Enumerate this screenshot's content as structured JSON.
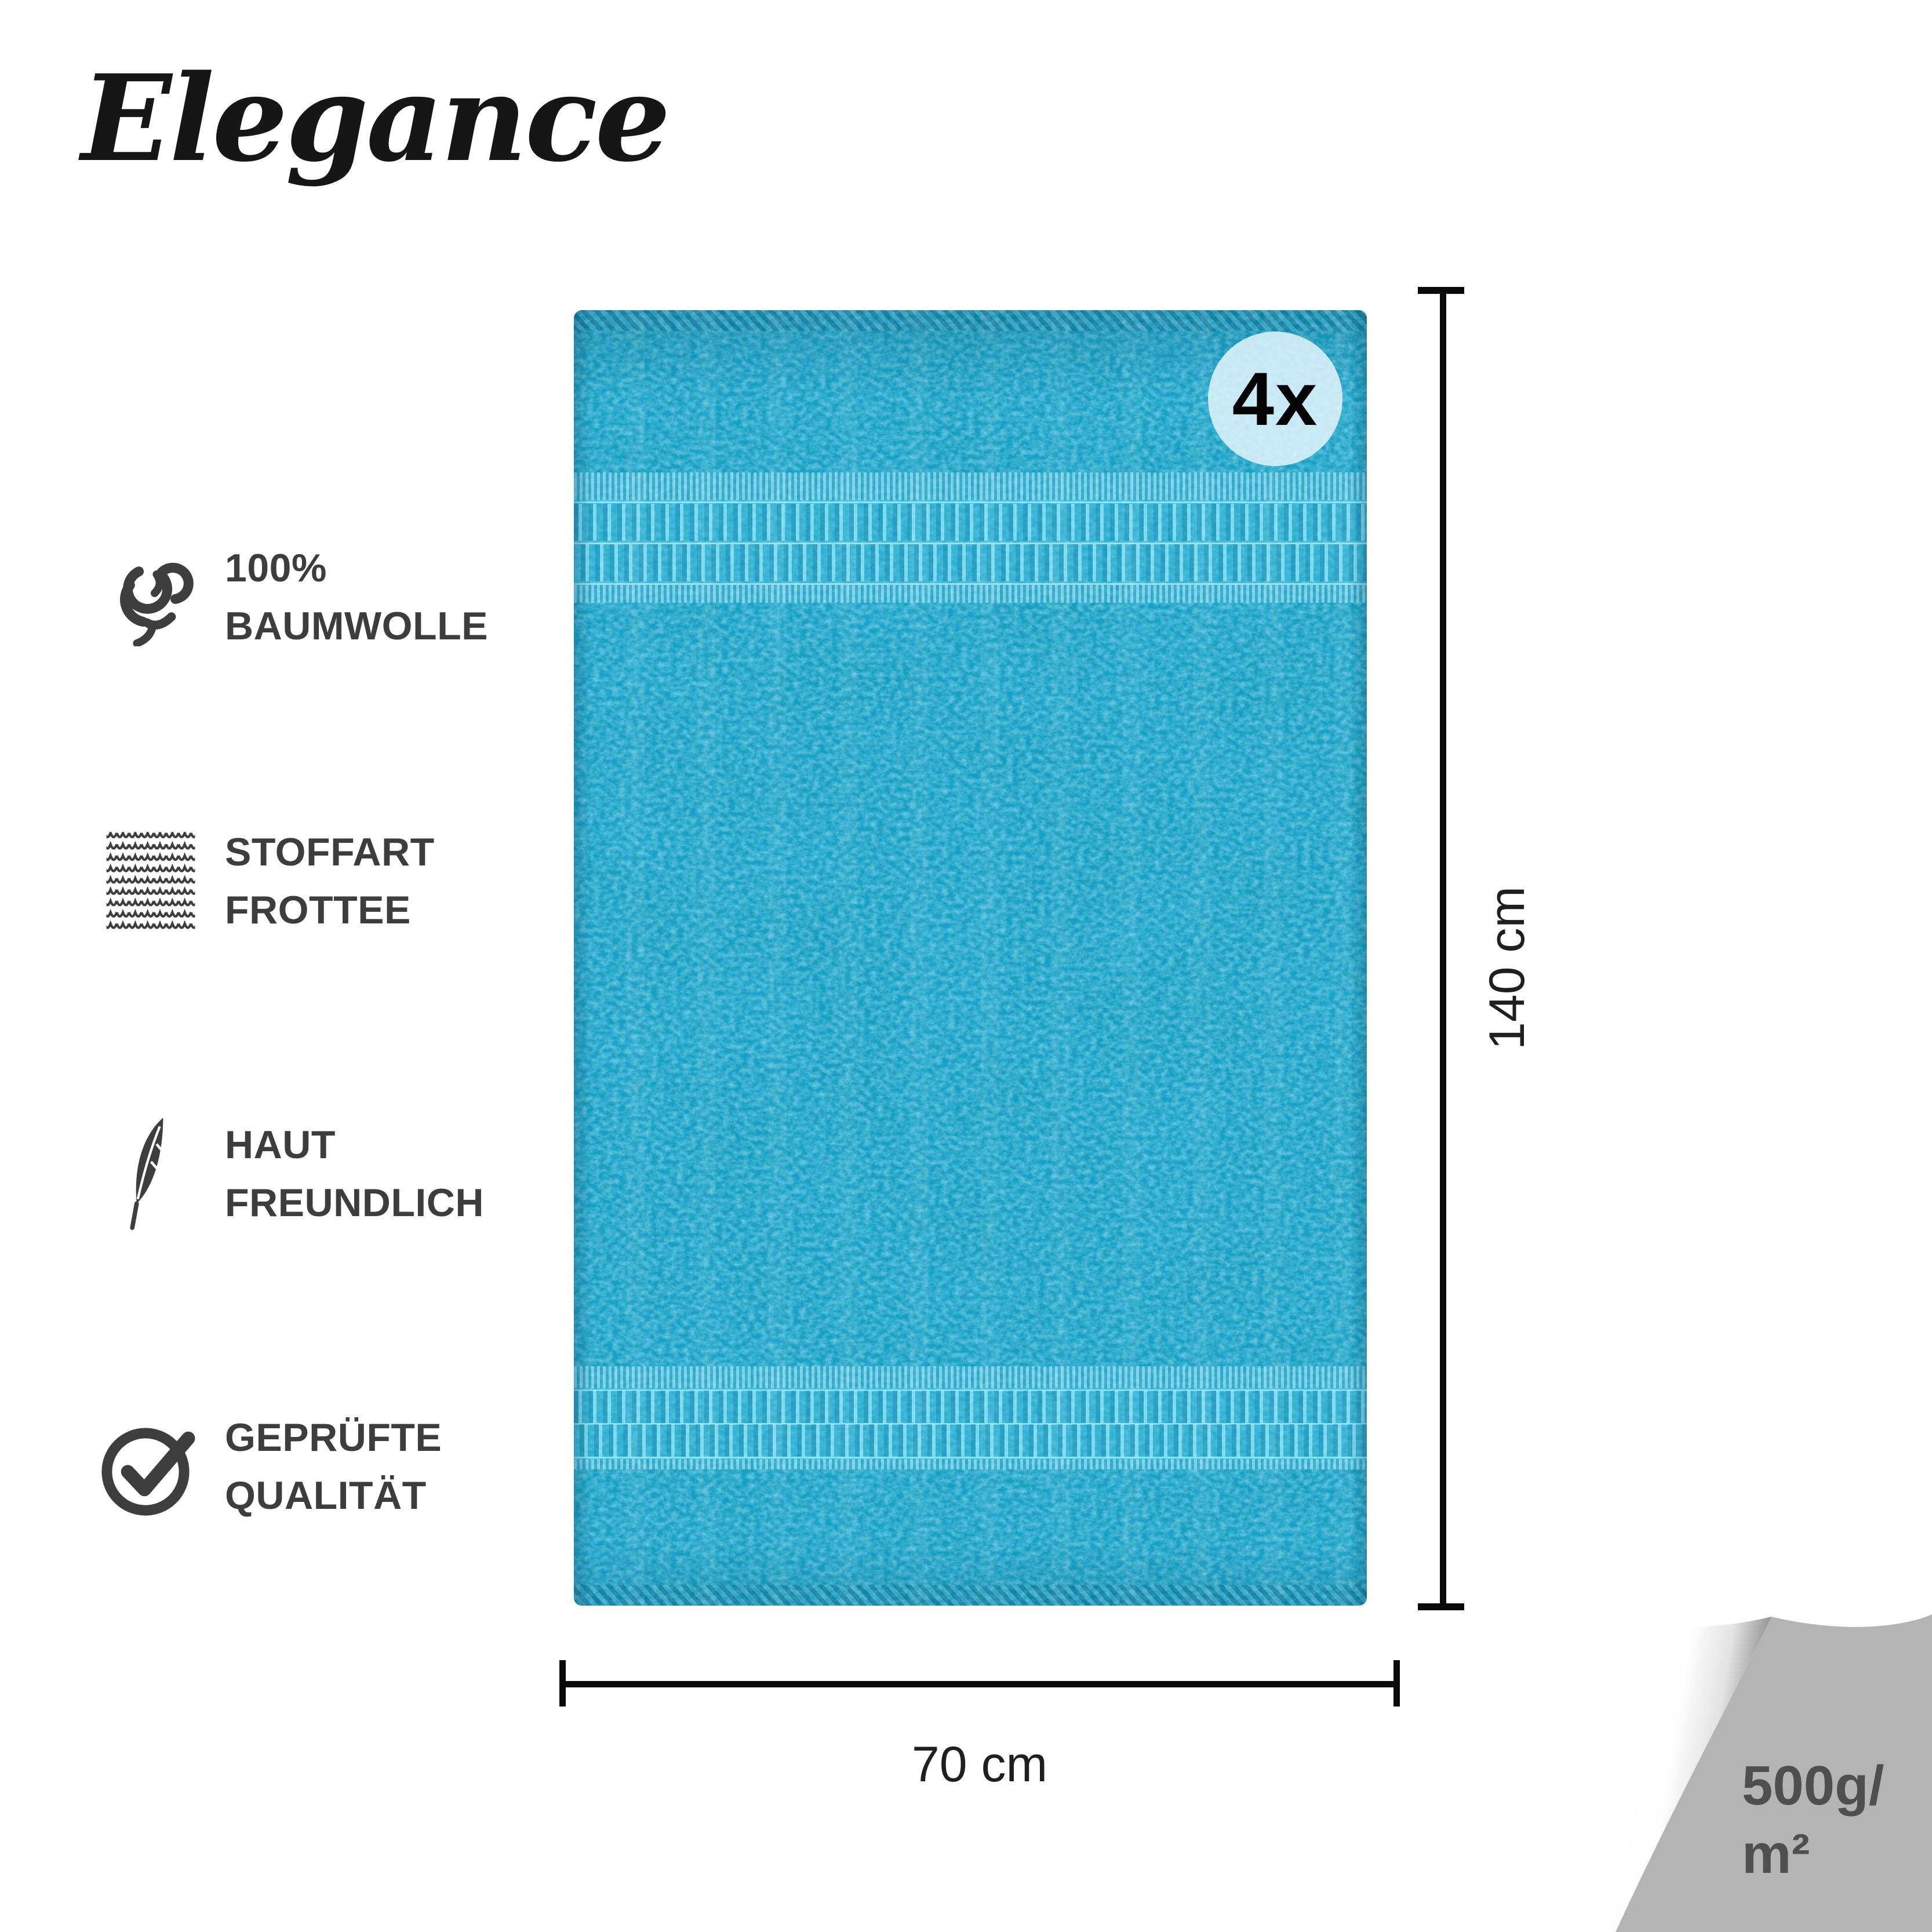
{
  "brand": {
    "logo_text": "Elegance"
  },
  "features": [
    {
      "icon": "cotton-icon",
      "line1": "100%",
      "line2": "BAUMWOLLE"
    },
    {
      "icon": "knit-fabric-icon",
      "line1": "STOFFART",
      "line2": "FROTTEE"
    },
    {
      "icon": "feather-icon",
      "line1": "HAUT",
      "line2": "FREUNDLICH"
    },
    {
      "icon": "check-circle-icon",
      "line1": "GEPRÜFTE",
      "line2": "QUALITÄT"
    }
  ],
  "product": {
    "quantity_badge": "4x",
    "dimensions": {
      "height": "140 cm",
      "width": "70 cm"
    },
    "weight": {
      "line1": "500g/",
      "line2": "m²"
    },
    "colors": {
      "towel_base": "#16a4ce",
      "towel_dark": "#0b82ad",
      "towel_light": "#35c2e8",
      "badge_bg": "#def3fa",
      "feature_text": "#3d3d3d",
      "dimension_text": "#1f1f1f",
      "corner_gray": "#b4b4b4",
      "weight_text": "#4f4f4f"
    }
  }
}
